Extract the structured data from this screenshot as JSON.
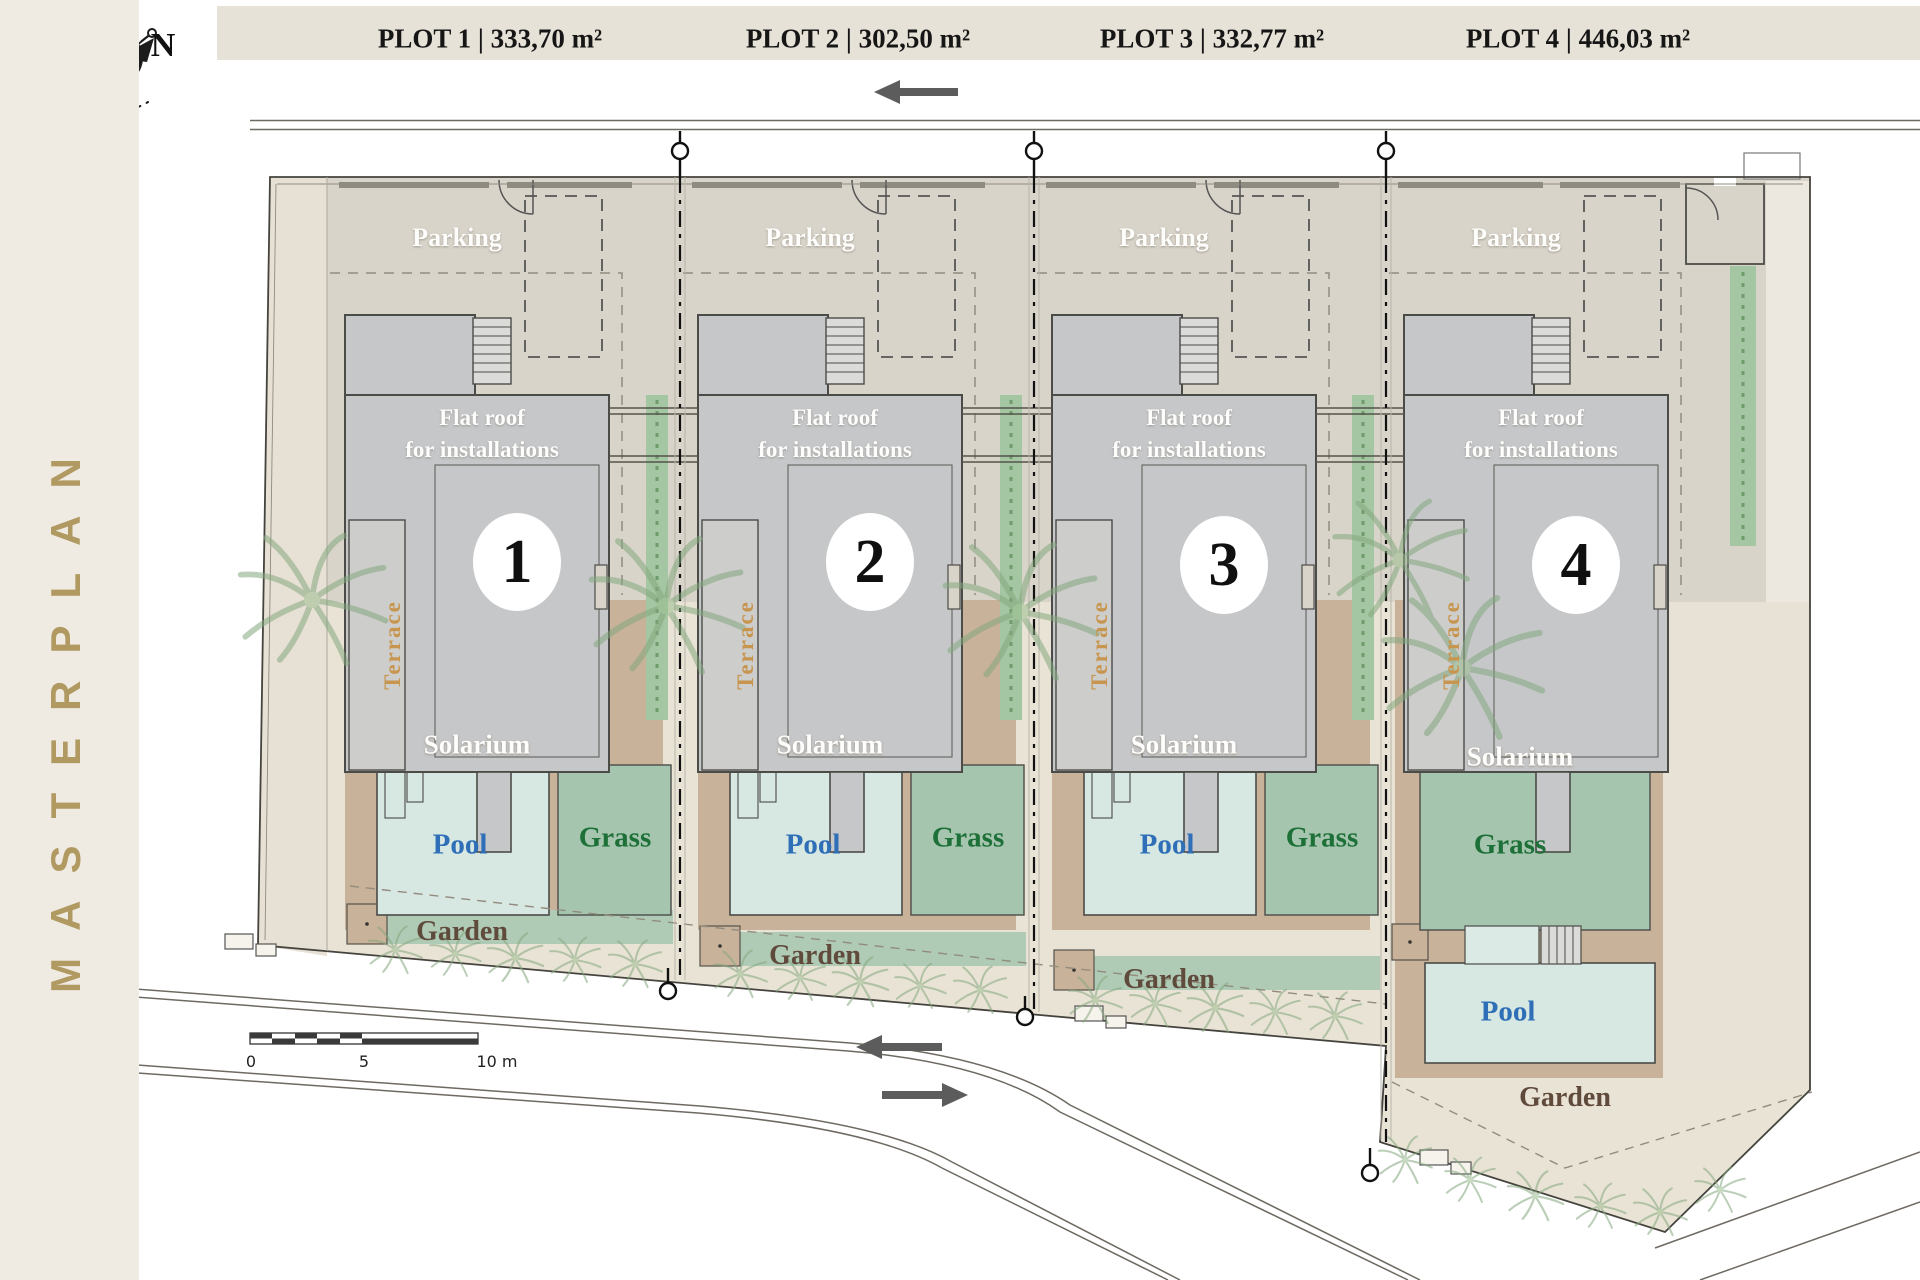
{
  "page": {
    "title": "MASTERPLAN"
  },
  "compass": {
    "north": "N"
  },
  "header": {
    "plot_labels": [
      "PLOT 1 | 333,70 m²",
      "PLOT 2 | 302,50 m²",
      "PLOT 3 | 332,77 m²",
      "PLOT 4 | 446,03 m²"
    ]
  },
  "plots": [
    {
      "number": "1",
      "header_label": "PLOT 1 | 333,70 m²",
      "parking": "Parking",
      "flat_roof_1": "Flat roof",
      "flat_roof_2": "for installations",
      "terrace": "Terrace",
      "solarium": "Solarium",
      "pool": "Pool",
      "grass": "Grass",
      "garden": "Garden"
    },
    {
      "number": "2",
      "header_label": "PLOT 2 | 302,50 m²",
      "parking": "Parking",
      "flat_roof_1": "Flat roof",
      "flat_roof_2": "for installations",
      "terrace": "Terrace",
      "solarium": "Solarium",
      "pool": "Pool",
      "grass": "Grass",
      "garden": "Garden"
    },
    {
      "number": "3",
      "header_label": "PLOT 3 | 332,77 m²",
      "parking": "Parking",
      "flat_roof_1": "Flat roof",
      "flat_roof_2": "for installations",
      "terrace": "Terrace",
      "solarium": "Solarium",
      "pool": "Pool",
      "grass": "Grass",
      "garden": "Garden"
    },
    {
      "number": "4",
      "header_label": "PLOT 4 | 446,03 m²",
      "parking": "Parking",
      "flat_roof_1": "Flat roof",
      "flat_roof_2": "for installations",
      "terrace": "Terrace",
      "solarium": "Solarium",
      "pool": "Pool",
      "grass": "Grass",
      "garden": "Garden"
    }
  ],
  "scale_bar": {
    "tick_0": "0",
    "tick_5": "5",
    "tick_10": "10 m"
  },
  "colors": {
    "sidebar_beige": "#EFEBE2",
    "header_beige": "#E7E2D7",
    "gold": "#B19962",
    "ground_base": "#E9E3D6",
    "parking_gray": "#D9D4CA",
    "building_gray": "#C6C7C9",
    "solarium_tan": "#C8B299",
    "pool_blue_fill": "#D7E7E1",
    "grass_green": "#A6C5AE",
    "pool_text_blue": "#2E6FB7",
    "grass_text_green": "#1D7038",
    "garden_text_brown": "#5F4A3C",
    "terrace_orange": "#C8954F",
    "hedge_green": "#A5C6A2"
  }
}
